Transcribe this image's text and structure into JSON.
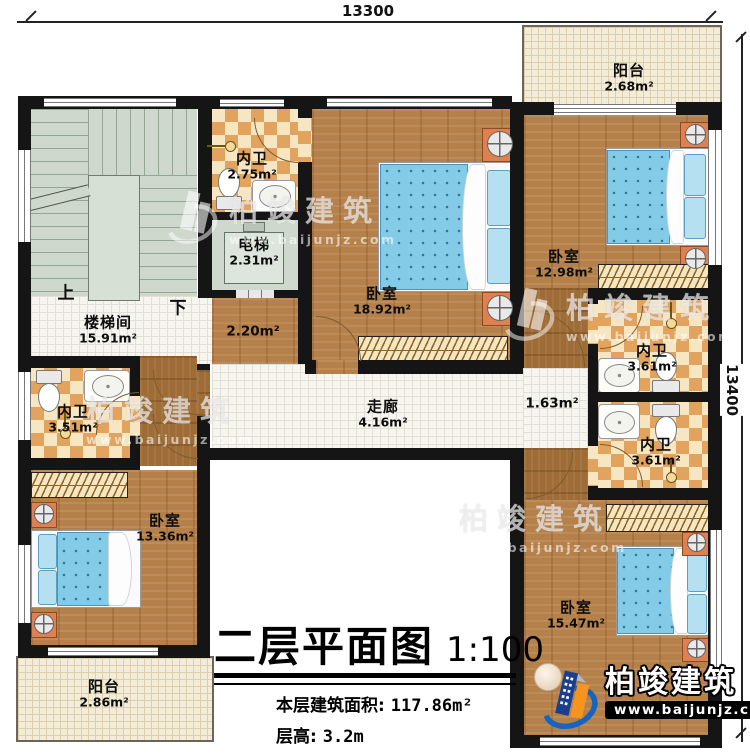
{
  "dimensions": {
    "top": "13300",
    "right": "13400"
  },
  "stairs": {
    "up": "上",
    "down": "下"
  },
  "rooms": {
    "stairwell": {
      "name": "楼梯间",
      "area": "15.91m²"
    },
    "bath_top": {
      "name": "内卫",
      "area": "2.75m²"
    },
    "elevator": {
      "name": "电梯",
      "area": "2.31m²"
    },
    "elevator_hall": {
      "area": "2.20m²"
    },
    "bedroom_master": {
      "name": "卧室",
      "area": "18.92m²"
    },
    "bedroom_topright": {
      "name": "卧室",
      "area": "12.98m²"
    },
    "bath_right_upper": {
      "name": "内卫",
      "area": "3.61m²"
    },
    "bath_right_lower": {
      "name": "内卫",
      "area": "3.61m²"
    },
    "bath_left": {
      "name": "内卫",
      "area": "3.51m²"
    },
    "bedroom_left": {
      "name": "卧室",
      "area": "13.36m²"
    },
    "bedroom_bottomright": {
      "name": "卧室",
      "area": "15.47m²"
    },
    "corridor": {
      "name": "走廊",
      "area": "4.16m²"
    },
    "corridor_side": {
      "area": "1.63m²"
    },
    "balcony_top": {
      "name": "阳台",
      "area": "2.68m²"
    },
    "balcony_bottom": {
      "name": "阳台",
      "area": "2.86m²"
    }
  },
  "title": {
    "main": "二层平面图",
    "scale": "1:100",
    "area_label": "本层建筑面积:",
    "area_value": "117.86m²",
    "height_label": "层高:",
    "height_value": "3.2m"
  },
  "watermark": {
    "brand": "柏竣建筑",
    "url": "www.baijunjz.com"
  },
  "colors": {
    "wall": "#151515",
    "wood_floor": "#b5804a",
    "dark_wood": "#9e6c36",
    "tile_checker": "#e2a35e",
    "bed_blue": "#83cbe7",
    "stair_gray": "#cfd8cd",
    "balcony_cream": "#f2ecd8",
    "logo_blue": "#1565c0",
    "logo_orange": "#f7941d"
  }
}
